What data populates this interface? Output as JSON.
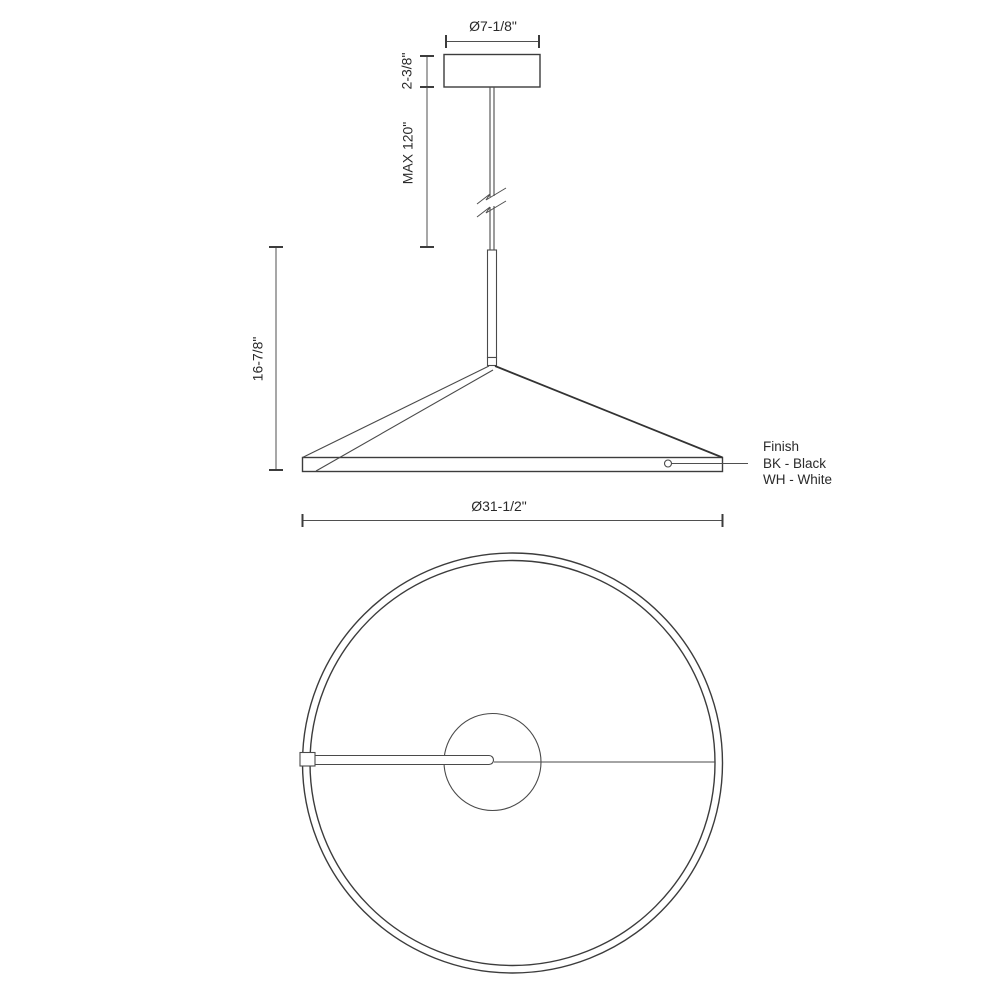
{
  "drawing": {
    "description": "Pendant light fixture technical dimension drawing, elevation and plan views",
    "elevation": {
      "canopy_diameter_label": "Ø7-1/8\"",
      "canopy_height_label": "2-3/8\"",
      "max_drop_label": "MAX 120\"",
      "fixture_height_label": "16-7/8\"",
      "ring_diameter_label": "Ø31-1/2\""
    },
    "finish_note": {
      "heading": "Finish",
      "options": [
        "BK - Black",
        "WH - White"
      ]
    },
    "colors": {
      "outline": "#3c3c3c",
      "dimension_line": "#4f4f4f",
      "text": "#2a2a2a",
      "background": "#ffffff"
    }
  }
}
